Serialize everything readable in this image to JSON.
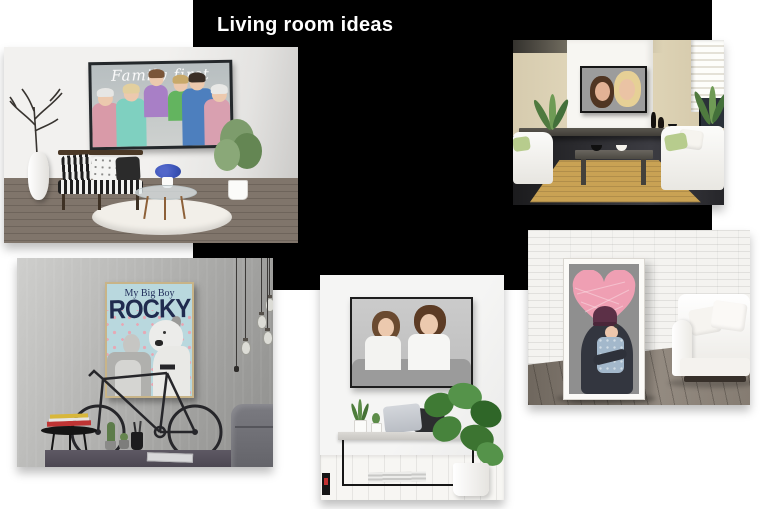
{
  "header": {
    "title": "Living room ideas"
  },
  "posters": {
    "family_caption": "Family first",
    "rocky_subtitle": "My Big Boy",
    "rocky_title": "ROCKY"
  },
  "colors": {
    "panel_bg": "#000000",
    "title_text": "#ffffff",
    "rocky_poster_bg": "#b9d8de",
    "rocky_poster_navy": "#202b4f",
    "paw_print_pink": "#e6a9b5",
    "heart_pink": "#ef9fb3",
    "beanie_plum": "#5c3047",
    "green_pillow_accent": "#b7cc8d"
  }
}
